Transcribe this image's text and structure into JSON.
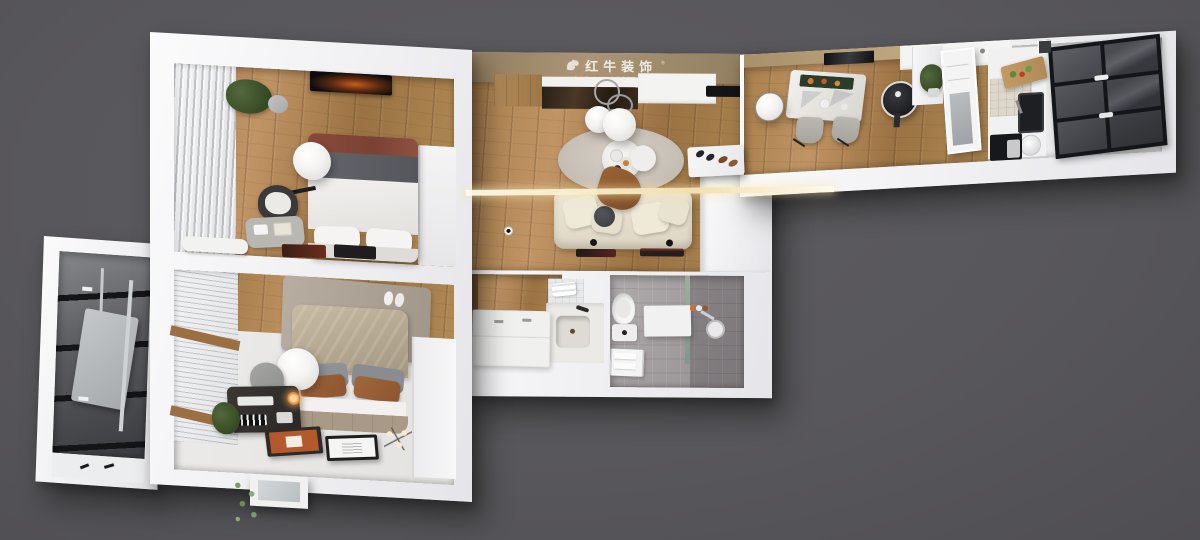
{
  "watermark": {
    "brand": "红牛装饰",
    "registered": "®",
    "subtitle": "HONG NIU DECORATION",
    "logo_icon": "bull-logo-icon"
  },
  "palette": {
    "background": "#58575b",
    "walls": "#f3f3f5",
    "wood_floor": "#a97f4c",
    "watermark_band": "#a08a6a",
    "glass_dark": "#3c3d42",
    "sofa_cream": "#e9e3d3",
    "bed_throw_red": "#8a4a3a",
    "accent_rust": "#b3592b",
    "tile_gray": "#a6a2a3",
    "lamp_white": "#f6f5f3"
  }
}
